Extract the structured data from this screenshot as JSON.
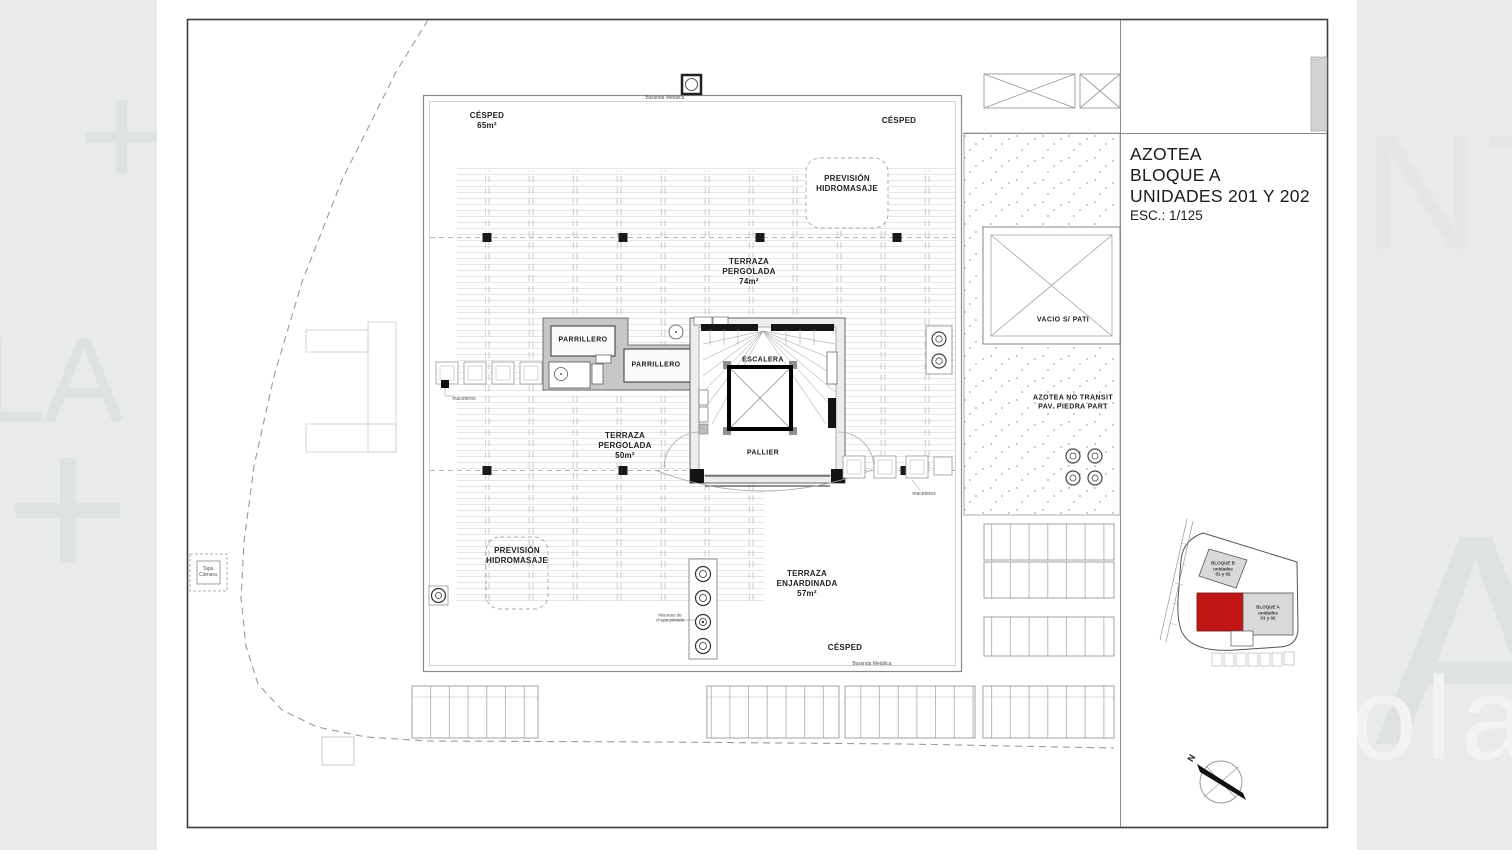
{
  "title_block": {
    "project": "AZOTEA",
    "block": "BLOQUE A",
    "units": "UNIDADES 201 Y 202",
    "scale": "ESC.: 1/125"
  },
  "plan_labels": {
    "baranda_top": "Baranda Metálica",
    "baranda_bottom": "Baranda Metálica",
    "cesped_topleft": "CÉSPED\n65m²",
    "cesped_topright": "CÉSPED",
    "cesped_bottom": "CÉSPED",
    "prevision_hidromasaje_top": "PREVISIÓN\nHIDROMASAJE",
    "prevision_hidromasaje_bottom": "PREVISIÓN\nHIDROMASAJE",
    "terraza_pergolada_74": "TERRAZA\nPERGOLADA\n74m²",
    "terraza_pergolada_50": "TERRAZA\nPERGOLADA\n50m²",
    "terraza_enjardinada": "TERRAZA\nENJARDINADA\n57m²",
    "parrillero_1": "PARRILLERO",
    "parrillero_2": "PARRILLERO",
    "escalera": "ESCALERA",
    "pallier": "PALLIER",
    "vacio": "VACIO S/ PATI",
    "azotea_no_transitable": "AZOTEA NO TRANSIT\nPAV. PIEDRA PART",
    "tapa_camara": "Tapa\nCámara",
    "maceteros_left": "maceteros",
    "maceteros_right": "maceteros",
    "macetas_chapa": "Macetas de\nchapa pintada"
  },
  "key_plan": {
    "bloque_b": "BLOQUE B\nunidades\n01 y 02",
    "bloque_a": "BLOQUE A\nunidades\n01 y 02",
    "highlight_color": "#c01616"
  },
  "north": {
    "label": "N"
  },
  "watermark": {
    "plus_top_left": "+",
    "letters_left": "LA",
    "plus_bottom_left": "+",
    "letters_top_right": "NT",
    "letter_right": "A",
    "letters_bottom_right": "olar"
  }
}
